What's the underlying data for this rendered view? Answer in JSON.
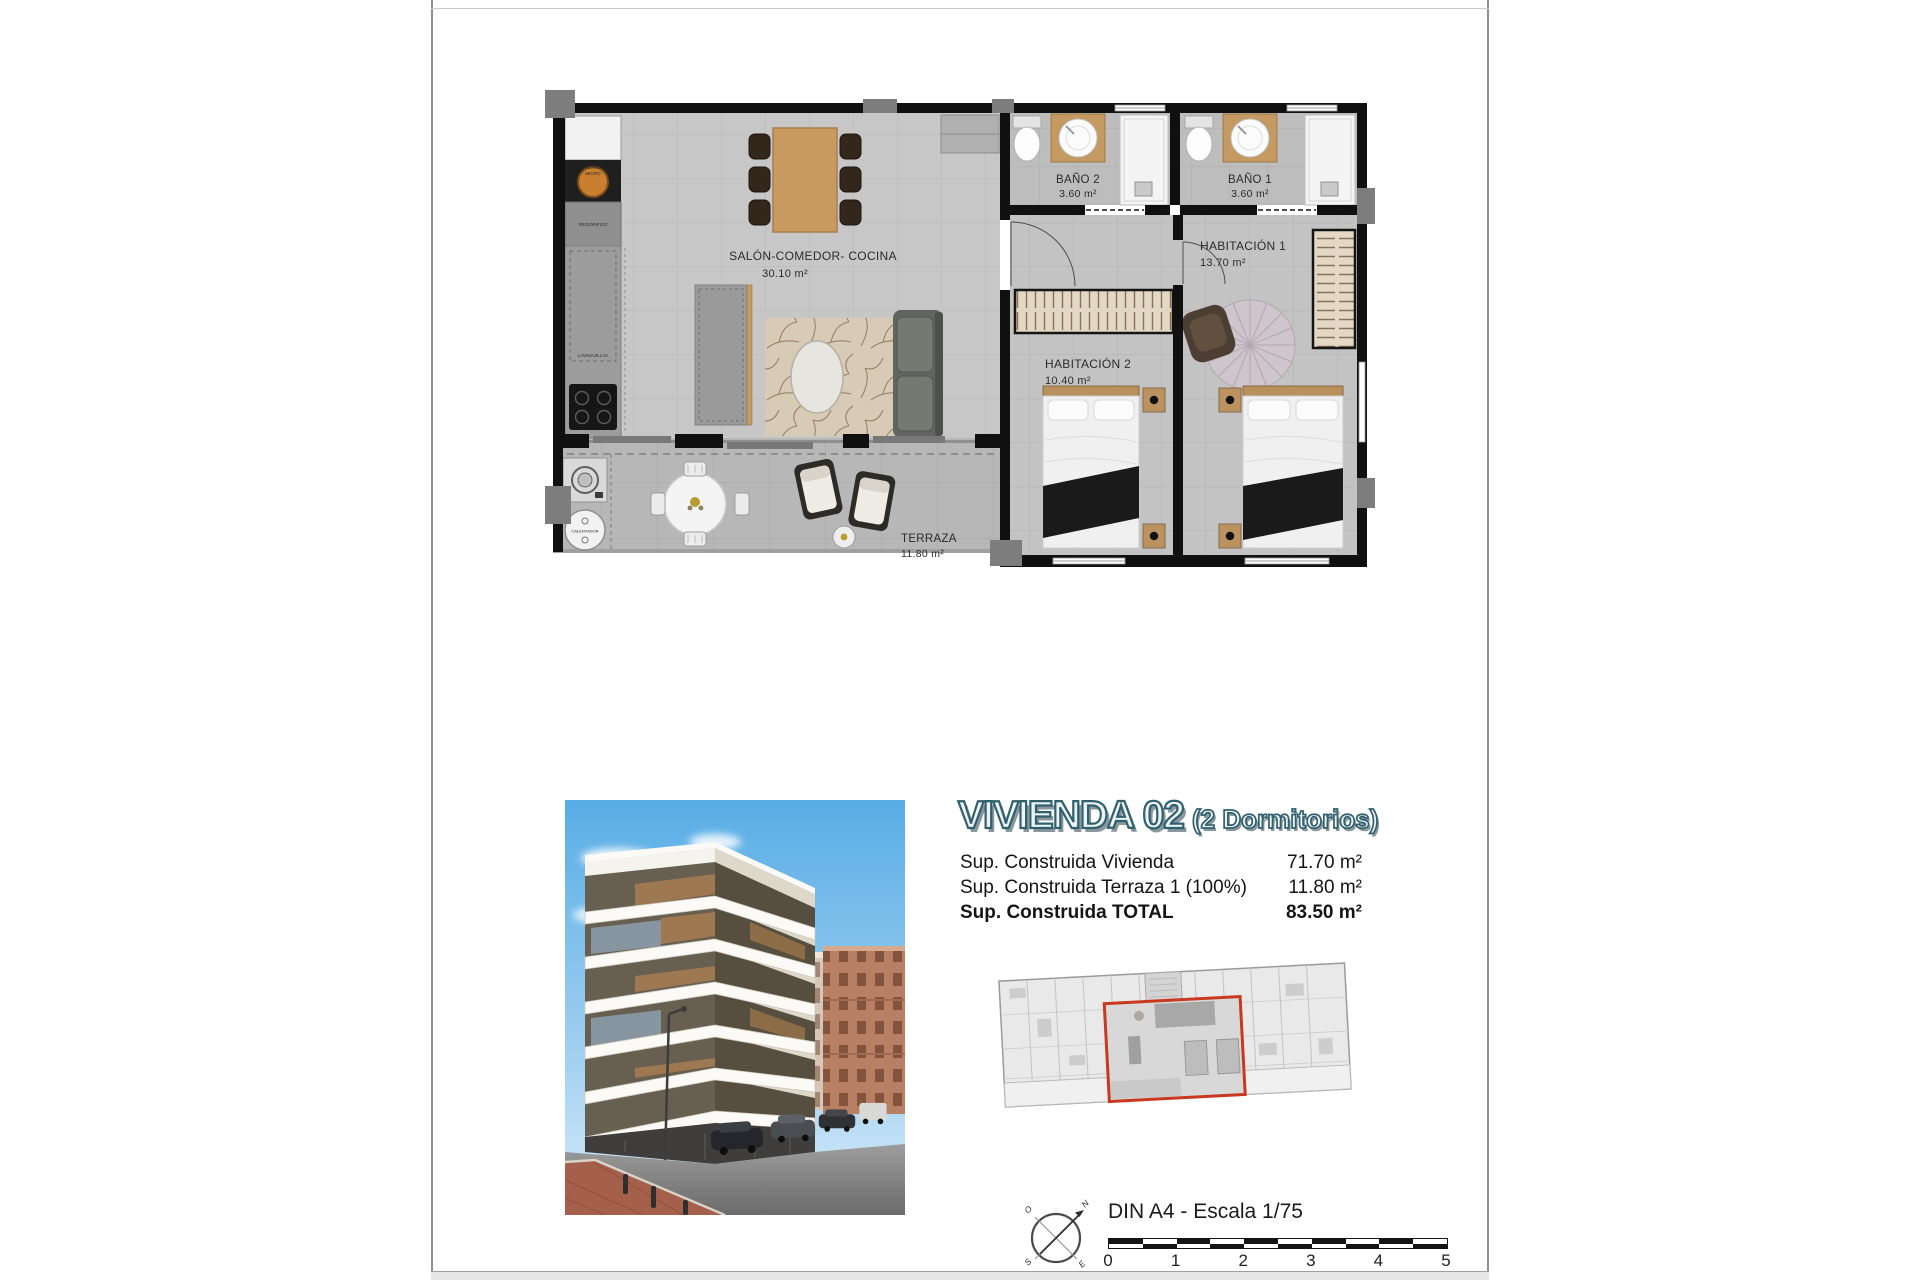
{
  "page": {
    "background": "#ffffff",
    "border_color": "#8f8f8f"
  },
  "floor_plan": {
    "rooms": [
      {
        "id": "salon",
        "label": "SALÓN-COMEDOR- COCINA",
        "area": "30.10 m²"
      },
      {
        "id": "bano2",
        "label": "BAÑO 2",
        "area": "3.60 m²"
      },
      {
        "id": "bano1",
        "label": "BAÑO 1",
        "area": "3.60 m²"
      },
      {
        "id": "habitacion1",
        "label": "HABITACIÓN 1",
        "area": "13.70 m²"
      },
      {
        "id": "habitacion2",
        "label": "HABITACIÓN 2",
        "area": "10.40 m²"
      },
      {
        "id": "terraza",
        "label": "TERRAZA",
        "area": "11.80 m²"
      }
    ],
    "appliances": {
      "horno_line1": "HORNO",
      "horno_line2": "MICRO",
      "frigorifico": "FRIGORIFICO",
      "lavavajillas": "LAVAVAJILLAS",
      "calentador": "CALENTADOR"
    }
  },
  "info": {
    "title": "VIVIENDA 02",
    "subtitle": "(2 Dormitorios)",
    "title_color": "#30606e",
    "rows": [
      {
        "label": "Sup. Construida Vivienda",
        "value": "71.70 m²"
      },
      {
        "label": "Sup. Construida Terraza 1 (100%)",
        "value": "11.80 m²"
      },
      {
        "label": "Sup. Construida TOTAL",
        "value": "83.50 m²"
      }
    ]
  },
  "key_plan": {
    "highlight_color": "#c8391f"
  },
  "footer": {
    "scale_text": "DIN A4 - Escala 1/75",
    "scale_numbers": [
      "0",
      "1",
      "2",
      "3",
      "4",
      "5"
    ],
    "compass": {
      "n": "N",
      "o": "O",
      "s": "S",
      "e": "E"
    }
  }
}
